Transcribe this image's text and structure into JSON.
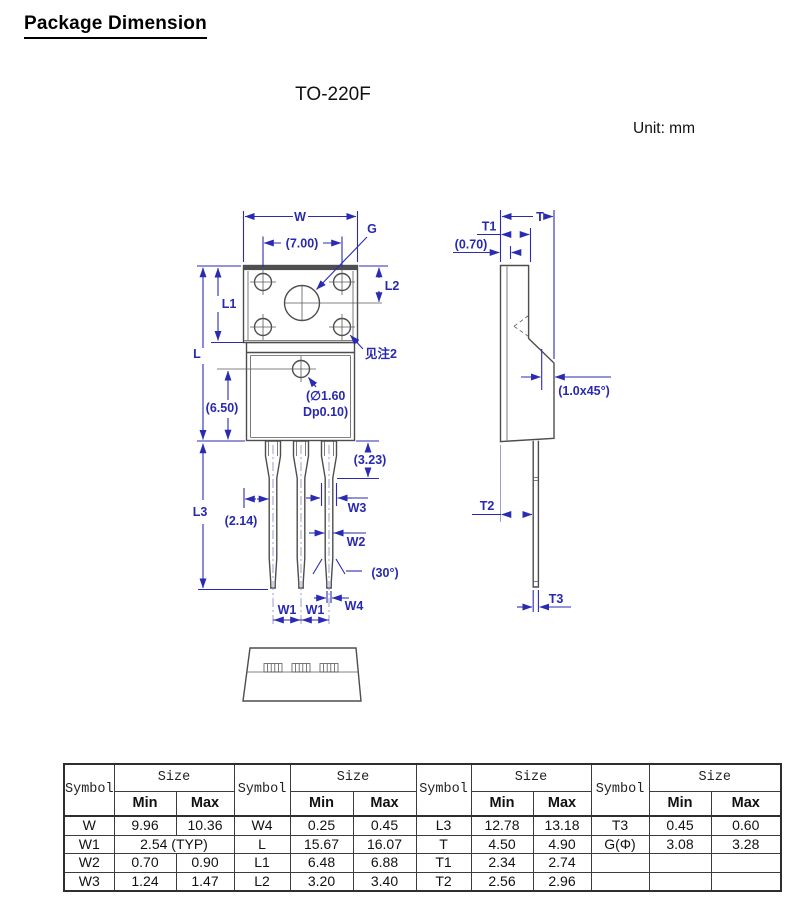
{
  "page": {
    "title": "Package Dimension",
    "package_name": "TO-220F",
    "unit_label": "Unit: mm"
  },
  "drawing": {
    "colors": {
      "dimension_blue": "#2a2ab2",
      "outline_gray": "#4d4d4d"
    },
    "front_labels": {
      "w": "W",
      "pitch7": "(7.00)",
      "g": "G",
      "l2": "L2",
      "l1": "L1",
      "l": "L",
      "see_note": "见注2",
      "hole_dia_line1": "(∅1.60",
      "hole_dia_line2": "Dp0.10)",
      "d650": "(6.50)",
      "d323": "(3.23)",
      "l3": "L3",
      "d214": "(2.14)",
      "w3": "W3",
      "w2": "W2",
      "angle30": "(30°)",
      "w4": "W4",
      "w1a": "W1",
      "w1b": "W1"
    },
    "side_labels": {
      "t": "T",
      "t1": "T1",
      "d070": "(0.70)",
      "chamfer": "(1.0x45°)",
      "t2": "T2",
      "t3": "T3"
    }
  },
  "table": {
    "header": {
      "symbol": "Symbol",
      "size": "Size",
      "min": "Min",
      "max": "Max"
    },
    "groups": [
      {
        "rows": [
          {
            "sym": "W",
            "min": "9.96",
            "max": "10.36"
          },
          {
            "sym": "W1",
            "merged": "2.54 (TYP)"
          },
          {
            "sym": "W2",
            "min": "0.70",
            "max": "0.90"
          },
          {
            "sym": "W3",
            "min": "1.24",
            "max": "1.47"
          }
        ]
      },
      {
        "rows": [
          {
            "sym": "W4",
            "min": "0.25",
            "max": "0.45"
          },
          {
            "sym": "L",
            "min": "15.67",
            "max": "16.07"
          },
          {
            "sym": "L1",
            "min": "6.48",
            "max": "6.88"
          },
          {
            "sym": "L2",
            "min": "3.20",
            "max": "3.40"
          }
        ]
      },
      {
        "rows": [
          {
            "sym": "L3",
            "min": "12.78",
            "max": "13.18"
          },
          {
            "sym": "T",
            "min": "4.50",
            "max": "4.90"
          },
          {
            "sym": "T1",
            "min": "2.34",
            "max": "2.74"
          },
          {
            "sym": "T2",
            "min": "2.56",
            "max": "2.96"
          }
        ]
      },
      {
        "rows": [
          {
            "sym": "T3",
            "min": "0.45",
            "max": "0.60"
          },
          {
            "sym": "G(Φ)",
            "min": "3.08",
            "max": "3.28"
          },
          {
            "sym": "",
            "min": "",
            "max": ""
          },
          {
            "sym": "",
            "min": "",
            "max": ""
          }
        ]
      }
    ]
  }
}
